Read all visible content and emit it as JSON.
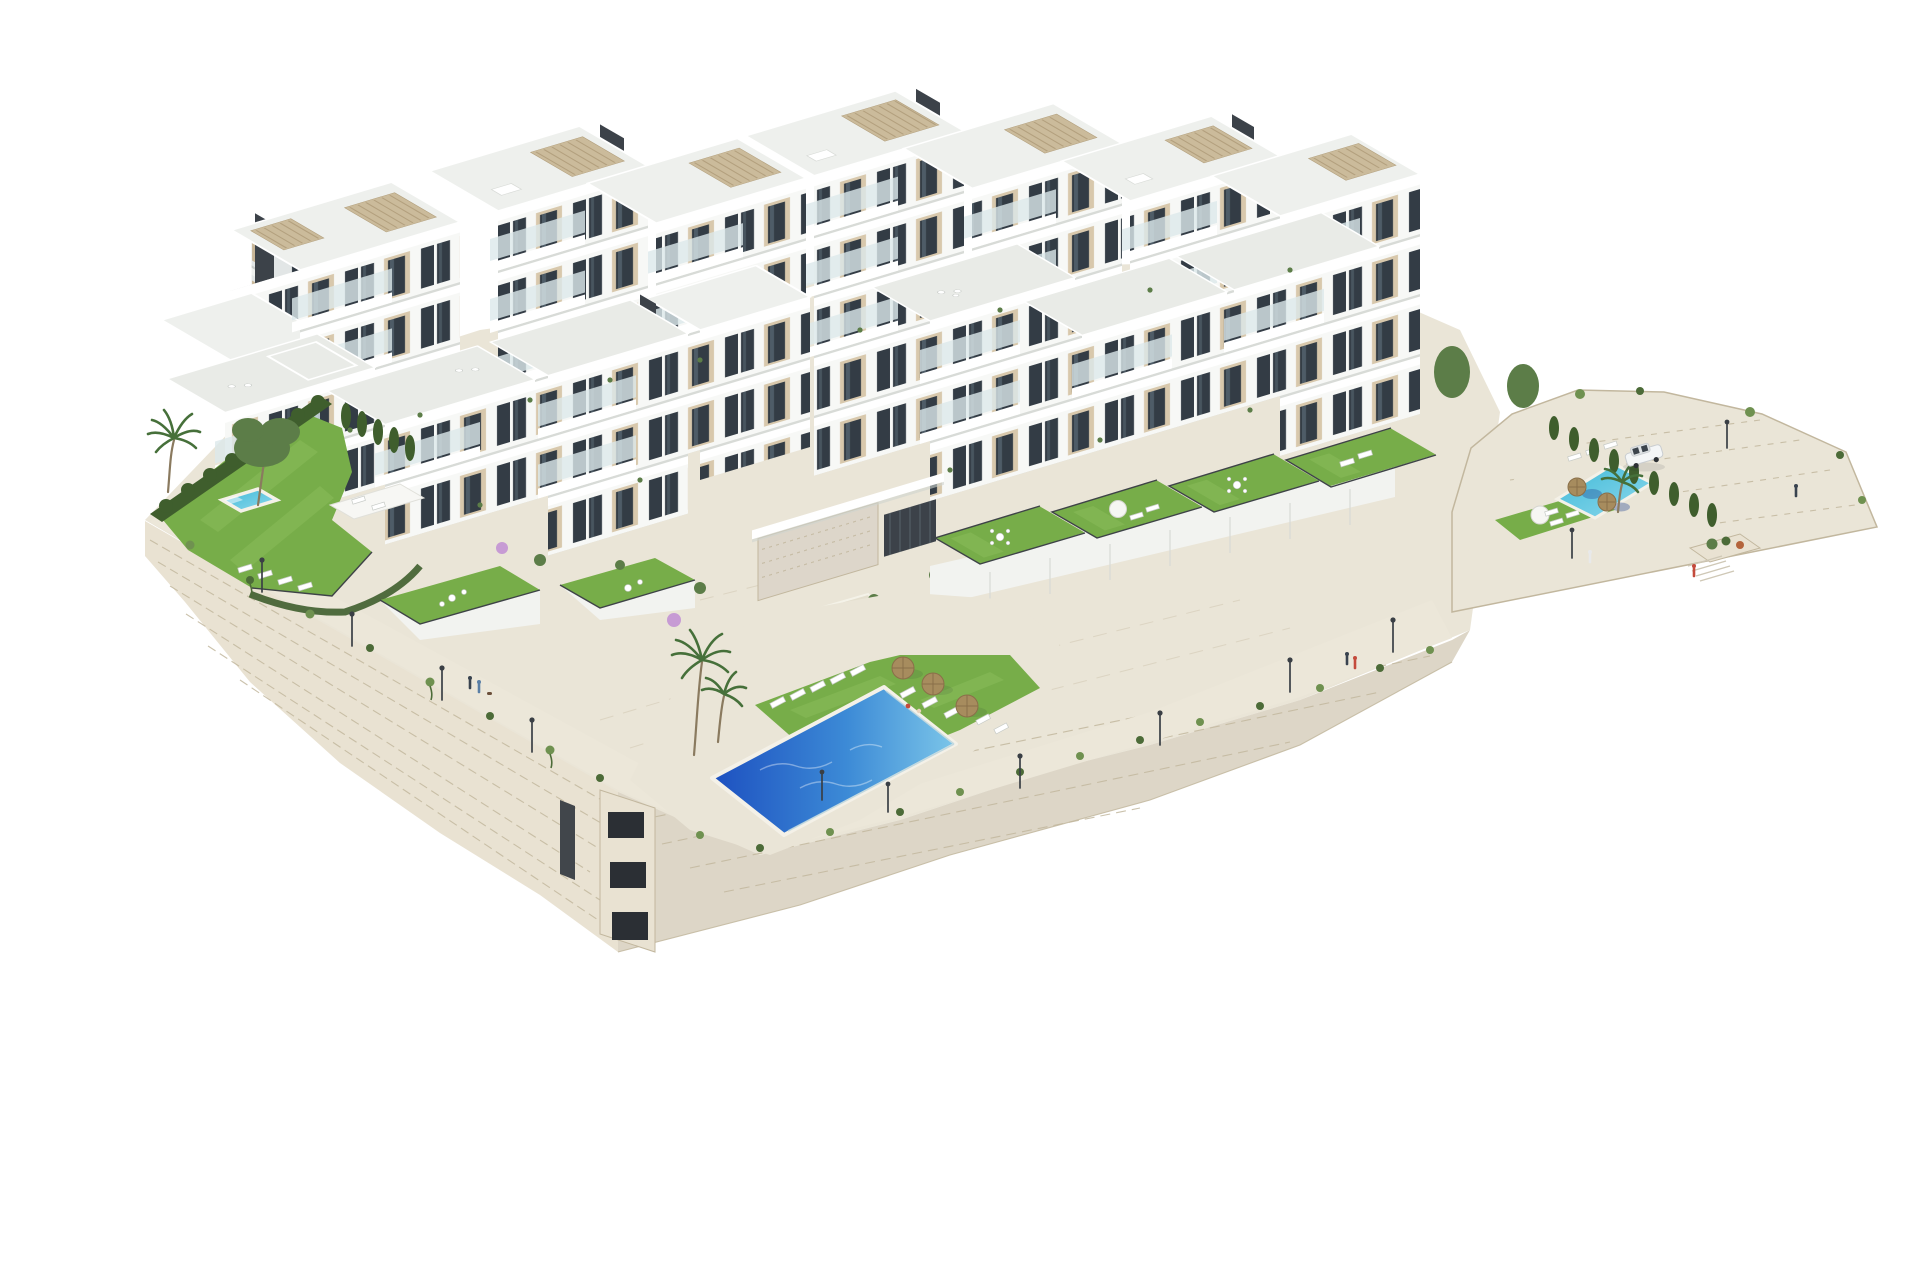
{
  "meta": {
    "image_type": "3D architectural rendering",
    "description": "Aerial isometric render of a modern white hillside residential complex with terraced apartment blocks, rooftop pergolas, landscaped gardens, three swimming pools and a stone perimeter retaining wall, floating on a plain white background.",
    "visible_text": "none"
  },
  "palette": {
    "bg": "#ffffff",
    "facade": "#f7f8f6",
    "facadeShade": "#e2e6e6",
    "slab": "#ffffff",
    "slabShadow": "#d8dbd7",
    "roof": "#eef0ed",
    "roofTerrace": "#e9ebe7",
    "beige": "#d8c8ac",
    "beigeShade": "#c8b697",
    "windowDark": "#333c45",
    "windowSide": "#2e3740",
    "windowReflect": "#5d6d79",
    "glass": "#dce8eb",
    "core": "#3c4249",
    "pergola": "#cbbb9b",
    "pergolaSlat": "#b3a07e",
    "stone": "#e9e2d2",
    "stoneLine": "#c2b79e",
    "stoneFeature": "#ddd6ca",
    "paving": "#eae5d7",
    "pavingLine": "#d5cdb9",
    "terraceWall": "#f2f3f0",
    "lawn": "#77ad49",
    "lawnLight": "#8abc5a",
    "hedge": "#3f5e2d",
    "tree": "#5c7d48",
    "palm": "#46703a",
    "fringe": "#6f9150",
    "fringeDark": "#4c6b38",
    "poolDeep": "#1d50c0",
    "poolMid": "#3c8ad6",
    "poolLight": "#7cc6e9",
    "poolTurq": "#3fb9d8",
    "poolTurqLight": "#8ed9ec",
    "fence": "#3e4347",
    "lamp": "#3a3f45",
    "carBody": "#f4f6f7",
    "carGlass": "#3c444c",
    "umbStraw": "#a78c5e",
    "umbStrawDark": "#8a6f49",
    "umbWhite": "#f6f6f3",
    "flower": "#b4643c",
    "bloom": "#c79bd4",
    "personDark": "#39434f",
    "personRed": "#c44b3c",
    "personBlue": "#5a7fa6"
  },
  "scene": {
    "buildings": {
      "back_towers": 8,
      "front_blocks": 7,
      "floors_range": "2 to 5",
      "facade_style": "white render with sand-beige panels, full-height dark glazing, white balcony slabs and glass balustrades",
      "rooftops": "flat roof terraces with beige slatted pergolas and dark stair/elevator cores"
    },
    "pools": [
      {
        "name": "main-pool",
        "location": "lower central esplanade",
        "colors": [
          "#1d50c0",
          "#3c8ad6",
          "#7cc6e9"
        ],
        "features": [
          "sun lounger rows",
          "3 straw umbrellas",
          "2 swimmers",
          "glass fence"
        ]
      },
      {
        "name": "left-garden-pool",
        "location": "left private garden",
        "colors": [
          "#3fb9d8",
          "#8ed9ec"
        ],
        "features": [
          "white deck",
          "4 sun loungers",
          "white pergola deck"
        ]
      },
      {
        "name": "right-terrace-pool",
        "location": "right terrace near parking",
        "colors": [
          "#3fb9d8",
          "#8ed9ec"
        ],
        "features": [
          "2 straw umbrellas",
          "lounger rows",
          "cypress hedge"
        ]
      }
    ],
    "landscape": {
      "lawns": 9,
      "palm_trees": 4,
      "pine_trees": 2,
      "cypress_hedges": 2,
      "wall_vegetation": "grass fringe and trailing plants over stone walls",
      "perimeter": "rough stone retaining walls with corner stairwell openings"
    },
    "props": {
      "street_lamps": 12,
      "car": {
        "color": "white",
        "location": "right parking strip"
      },
      "people": 9,
      "sun_loungers": 23,
      "umbrellas": {
        "straw": 5,
        "white": 1
      },
      "garden_furniture": [
        "outdoor sofa sets",
        "dining tables",
        "roof terrace loungers"
      ]
    }
  }
}
